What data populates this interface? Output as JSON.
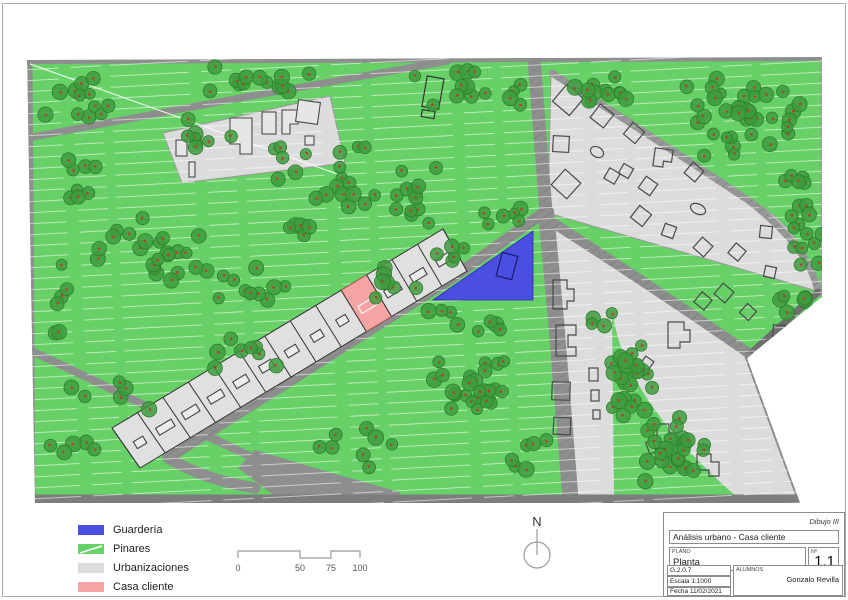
{
  "legend": {
    "items": [
      {
        "label": "Guardería",
        "color": "#4A4FE2"
      },
      {
        "label": "Pinares",
        "color": "#64D264"
      },
      {
        "label": "Urbanizaciones",
        "color": "#DCDCDC"
      },
      {
        "label": "Casa cliente",
        "color": "#F5A3A3"
      }
    ]
  },
  "scale_bar": {
    "labels": [
      "0",
      "50",
      "75",
      "100"
    ]
  },
  "north_arrow": {
    "label": "N"
  },
  "title_block": {
    "course": "Dibujo III",
    "title": "Análisis urbano - Casa cliente",
    "plan_label": "PLANO",
    "plan_name": "Planta",
    "sheet_label": "Nº",
    "sheet_number": "1.1",
    "code": "G.2.0.7",
    "scale": "Escala 1:1000",
    "date": "Fecha 11/02/2021",
    "students_label": "ALUMNOS",
    "student_name": "Gonzalo Revilla"
  },
  "colors": {
    "pinares": "#67D067",
    "guarderia": "#4A4FE2",
    "urbanizacion": "#DCDCDC",
    "casa_cliente": "#F5A3A3",
    "road": "#8E8E8E",
    "tree": "#3E9B3E"
  }
}
